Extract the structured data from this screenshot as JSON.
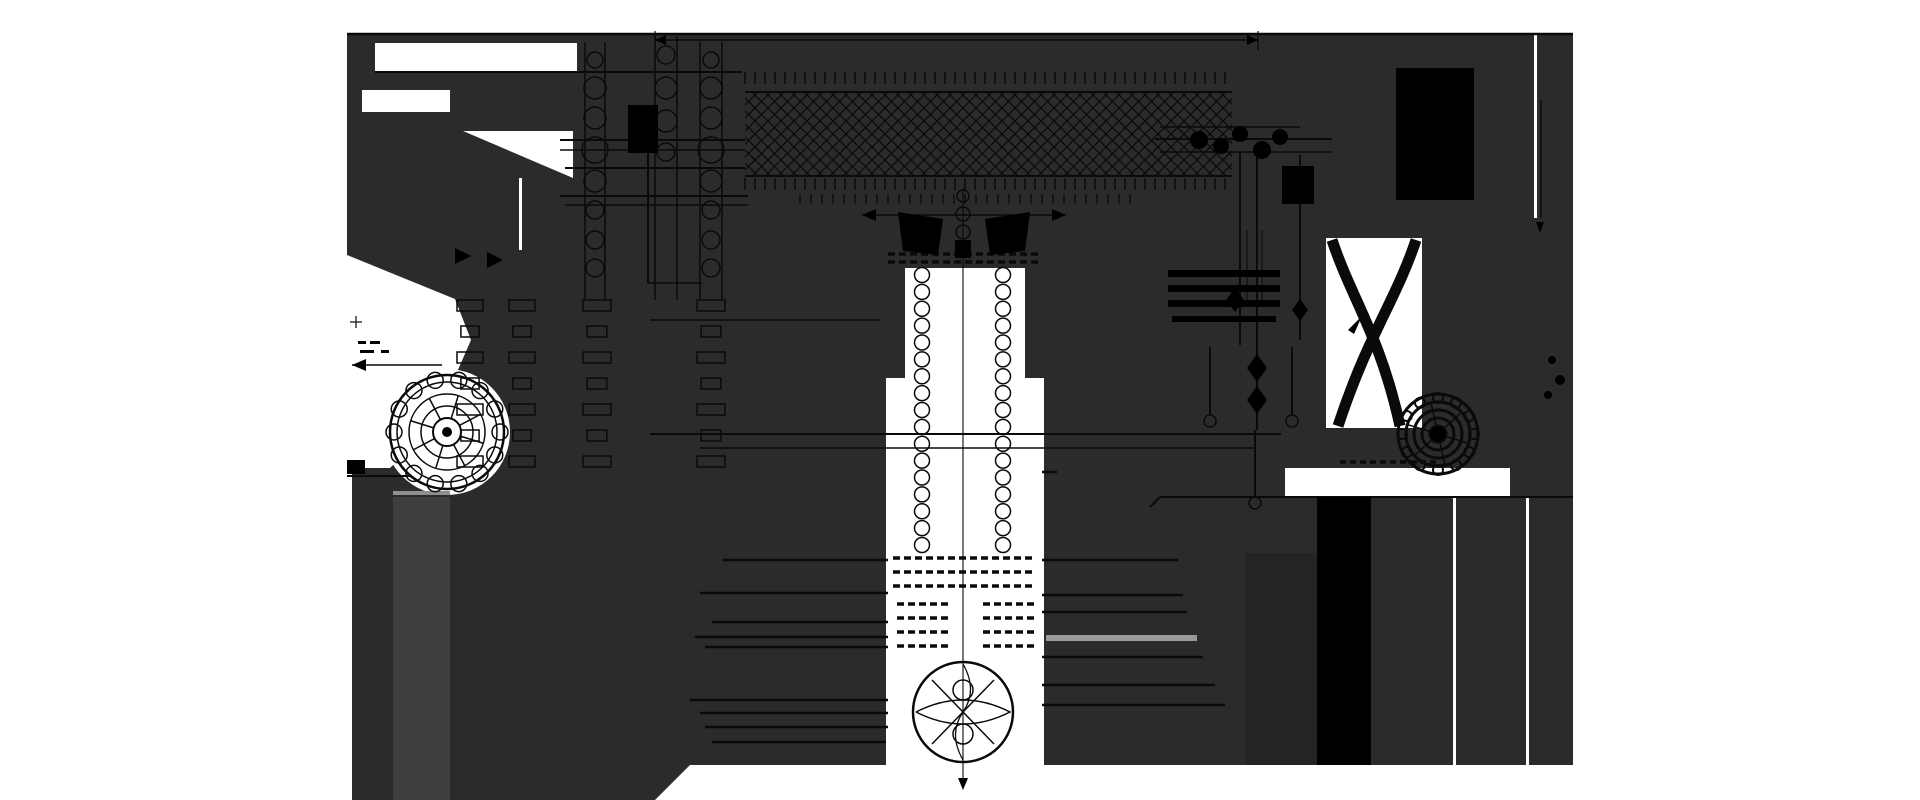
{
  "meta": {
    "title": "Monochrome engineering cross-section drawing, dark sheet silhouette with black line work",
    "width": 1920,
    "height": 800
  },
  "palette": {
    "bg": "#ffffff",
    "panel": "#2b2b2b",
    "slab": "#242424",
    "ink": "#0a0a0a",
    "solid": "#000000",
    "gray_bar": "#9a9a9a",
    "gray_band": "#3f3f3f",
    "gray_band_top": "#8f8f8f"
  },
  "silhouette": {
    "panel": [
      [
        347,
        33
      ],
      [
        1573,
        33
      ],
      [
        1573,
        765
      ],
      [
        690,
        765
      ],
      [
        655,
        800
      ],
      [
        352,
        800
      ],
      [
        352,
        470
      ],
      [
        347,
        462
      ]
    ],
    "cutout_rects": [
      [
        375,
        43,
        202,
        29
      ],
      [
        362,
        90,
        88,
        22
      ],
      [
        519,
        178,
        3,
        72
      ],
      [
        1285,
        468,
        225,
        29
      ],
      [
        1534,
        34,
        3,
        184
      ],
      [
        1453,
        497,
        3,
        268
      ],
      [
        1526,
        497,
        3,
        268
      ],
      [
        1326,
        238,
        96,
        190
      ],
      [
        905,
        268,
        120,
        112
      ],
      [
        886,
        378,
        158,
        422
      ]
    ],
    "cutout_polys": [
      [
        [
          463,
          131
        ],
        [
          573,
          131
        ],
        [
          573,
          178
        ]
      ],
      [
        [
          347,
          255
        ],
        [
          455,
          299
        ],
        [
          471,
          340
        ],
        [
          434,
          425
        ],
        [
          390,
          468
        ],
        [
          347,
          468
        ]
      ]
    ],
    "cutout_circles": [
      [
        447,
        432,
        63
      ]
    ]
  },
  "fills": {
    "gray_band": [
      393,
      497,
      57,
      303
    ],
    "gray_band_top": [
      393,
      491,
      57,
      4
    ],
    "pedestal_slab": [
      1245,
      553,
      72,
      212
    ]
  },
  "hatch": {
    "x": 745,
    "y": 92,
    "w": 487,
    "h": 84,
    "spacing": 13,
    "stroke_w": 1.2
  },
  "tick_rows": [
    {
      "y0": 72,
      "y1": 84,
      "x0": 745,
      "x1": 1232,
      "step": 10,
      "w": 1.5
    },
    {
      "y0": 178,
      "y1": 190,
      "x0": 745,
      "x1": 1232,
      "step": 10,
      "w": 1.5
    },
    {
      "y0": 194,
      "y1": 204,
      "x0": 800,
      "x1": 1140,
      "step": 11,
      "w": 1.2
    }
  ],
  "dash_rows": [
    {
      "y": 254,
      "x0": 888,
      "x1": 1038
    },
    {
      "y": 262,
      "x0": 888,
      "x1": 1038
    },
    {
      "y": 558,
      "x0": 893,
      "x1": 1035
    },
    {
      "y": 572,
      "x0": 893,
      "x1": 1035
    },
    {
      "y": 586,
      "x0": 893,
      "x1": 1035
    },
    {
      "y": 604,
      "x0": 897,
      "x1": 950
    },
    {
      "y": 604,
      "x0": 983,
      "x1": 1036
    },
    {
      "y": 618,
      "x0": 897,
      "x1": 950
    },
    {
      "y": 618,
      "x0": 983,
      "x1": 1036
    },
    {
      "y": 632,
      "x0": 897,
      "x1": 950
    },
    {
      "y": 632,
      "x0": 983,
      "x1": 1036
    },
    {
      "y": 646,
      "x0": 897,
      "x1": 950
    },
    {
      "y": 646,
      "x0": 983,
      "x1": 1036
    }
  ],
  "bead_chains": [
    {
      "cx": 922,
      "y0": 275,
      "y1": 545,
      "r": 7.5,
      "n": 17
    },
    {
      "cx": 1003,
      "y0": 275,
      "y1": 545,
      "r": 7.5,
      "n": 17
    }
  ],
  "nut_stacks": [
    {
      "cx": 470,
      "y0": 300,
      "y1": 470,
      "w": 26,
      "h": 11,
      "step": 26
    },
    {
      "cx": 522,
      "y0": 300,
      "y1": 470,
      "w": 26,
      "h": 11,
      "step": 26
    },
    {
      "cx": 597,
      "y0": 300,
      "y1": 470,
      "w": 28,
      "h": 11,
      "step": 26
    },
    {
      "cx": 711,
      "y0": 300,
      "y1": 470,
      "w": 28,
      "h": 11,
      "step": 26
    }
  ],
  "lines": [
    [
      347,
      34,
      1573,
      34,
      2.5
    ],
    [
      655,
      40,
      1258,
      40,
      1.5
    ],
    [
      655,
      31,
      655,
      50,
      1.2
    ],
    [
      1258,
      31,
      1258,
      50,
      1.2
    ],
    [
      648,
      113,
      648,
      283,
      2
    ],
    [
      648,
      283,
      702,
      283,
      1.5
    ],
    [
      375,
      72,
      742,
      72,
      2
    ],
    [
      560,
      140,
      745,
      140,
      2
    ],
    [
      560,
      150,
      745,
      150,
      1.5
    ],
    [
      565,
      168,
      745,
      168,
      2
    ],
    [
      560,
      196,
      748,
      196,
      2
    ],
    [
      565,
      205,
      748,
      205,
      1.5
    ],
    [
      585,
      42,
      585,
      300,
      1.5
    ],
    [
      605,
      42,
      605,
      300,
      1.5
    ],
    [
      655,
      36,
      655,
      300,
      1.5
    ],
    [
      677,
      36,
      677,
      300,
      1.5
    ],
    [
      700,
      42,
      700,
      300,
      1.5
    ],
    [
      722,
      42,
      722,
      300,
      1.5
    ],
    [
      745,
      92,
      1232,
      92,
      2
    ],
    [
      745,
      176,
      1232,
      176,
      2
    ],
    [
      862,
      215,
      1066,
      215,
      1.5
    ],
    [
      650,
      320,
      880,
      320,
      1.5
    ],
    [
      650,
      434,
      1281,
      434,
      2
    ],
    [
      700,
      448,
      1256,
      448,
      1.5
    ],
    [
      1160,
      127,
      1300,
      127,
      1.5
    ],
    [
      1155,
      139,
      1332,
      139,
      2
    ],
    [
      1160,
      152,
      1332,
      152,
      1.5
    ],
    [
      1240,
      152,
      1240,
      345,
      2
    ],
    [
      1257,
      150,
      1257,
      430,
      2
    ],
    [
      1300,
      155,
      1300,
      340,
      2
    ],
    [
      1247,
      230,
      1247,
      300,
      1
    ],
    [
      1262,
      230,
      1262,
      300,
      1
    ],
    [
      1160,
      497,
      1573,
      497,
      2
    ],
    [
      1150,
      507,
      1160,
      497,
      2
    ],
    [
      1541,
      100,
      1541,
      218,
      1.5
    ],
    [
      963,
      188,
      963,
      788,
      1.1
    ],
    [
      1210,
      347,
      1210,
      415,
      2
    ],
    [
      1292,
      347,
      1292,
      415,
      2
    ],
    [
      1255,
      430,
      1255,
      497,
      2
    ],
    [
      723,
      560,
      888,
      560,
      2.5
    ],
    [
      700,
      593,
      888,
      593,
      2.5
    ],
    [
      712,
      622,
      888,
      622,
      2.5
    ],
    [
      695,
      637,
      888,
      637,
      2.5
    ],
    [
      705,
      647,
      888,
      647,
      2.5
    ],
    [
      690,
      700,
      888,
      700,
      2.5
    ],
    [
      700,
      713,
      888,
      713,
      2.5
    ],
    [
      705,
      727,
      888,
      727,
      2.5
    ],
    [
      712,
      742,
      886,
      742,
      2.5
    ],
    [
      1042,
      472,
      1057,
      472,
      2.5
    ],
    [
      1042,
      560,
      1178,
      560,
      2.5
    ],
    [
      1042,
      595,
      1183,
      595,
      2.5
    ],
    [
      1042,
      612,
      1187,
      612,
      2.5
    ],
    [
      1042,
      657,
      1203,
      657,
      2.5
    ],
    [
      1042,
      685,
      1215,
      685,
      2.5
    ],
    [
      1042,
      705,
      1225,
      705,
      2.5
    ],
    [
      352,
      365,
      442,
      365,
      1.5
    ],
    [
      350,
      322,
      362,
      322,
      1.2
    ],
    [
      356,
      316,
      356,
      328,
      1.2
    ],
    [
      347,
      476,
      412,
      476,
      2
    ],
    [
      932,
      744,
      994,
      680,
      1.5
    ],
    [
      932,
      680,
      994,
      744,
      1.5
    ]
  ],
  "gray_lines": [
    [
      1046,
      638,
      1197,
      638,
      6
    ]
  ],
  "rects_black": [
    [
      628,
      105,
      30,
      48
    ],
    [
      1396,
      68,
      78,
      132
    ],
    [
      1317,
      497,
      54,
      268
    ],
    [
      1282,
      166,
      32,
      38
    ],
    [
      955,
      240,
      16,
      18
    ],
    [
      1168,
      270,
      112,
      7
    ],
    [
      1168,
      285,
      112,
      7
    ],
    [
      1168,
      300,
      112,
      7
    ],
    [
      1172,
      316,
      104,
      6
    ],
    [
      347,
      460,
      18,
      14
    ],
    [
      358,
      341,
      8,
      3
    ],
    [
      370,
      341,
      10,
      3
    ],
    [
      360,
      350,
      14,
      3
    ],
    [
      381,
      350,
      8,
      3
    ]
  ],
  "polys_black": [
    [
      [
        655,
        40
      ],
      [
        666,
        35
      ],
      [
        666,
        45
      ]
    ],
    [
      [
        1258,
        40
      ],
      [
        1247,
        35
      ],
      [
        1247,
        45
      ]
    ],
    [
      [
        862,
        215
      ],
      [
        876,
        209
      ],
      [
        876,
        221
      ]
    ],
    [
      [
        1066,
        215
      ],
      [
        1052,
        209
      ],
      [
        1052,
        221
      ]
    ],
    [
      [
        352,
        365
      ],
      [
        366,
        359
      ],
      [
        366,
        371
      ]
    ],
    [
      [
        898,
        212
      ],
      [
        943,
        219
      ],
      [
        938,
        255
      ],
      [
        903,
        251
      ]
    ],
    [
      [
        1030,
        212
      ],
      [
        985,
        219
      ],
      [
        990,
        255
      ],
      [
        1025,
        251
      ]
    ],
    [
      [
        455,
        248
      ],
      [
        471,
        256
      ],
      [
        455,
        264
      ]
    ],
    [
      [
        487,
        252
      ],
      [
        503,
        260
      ],
      [
        487,
        268
      ]
    ],
    [
      [
        1536,
        222
      ],
      [
        1544,
        222
      ],
      [
        1540,
        233
      ]
    ],
    [
      [
        963,
        790
      ],
      [
        958,
        778
      ],
      [
        968,
        778
      ]
    ],
    [
      [
        1235,
        288
      ],
      [
        1244,
        300
      ],
      [
        1235,
        312
      ],
      [
        1226,
        300
      ]
    ],
    [
      [
        1257,
        354
      ],
      [
        1267,
        368
      ],
      [
        1257,
        382
      ],
      [
        1247,
        368
      ]
    ],
    [
      [
        1257,
        386
      ],
      [
        1267,
        400
      ],
      [
        1257,
        414
      ],
      [
        1247,
        400
      ]
    ],
    [
      [
        1300,
        299
      ],
      [
        1308,
        310
      ],
      [
        1300,
        321
      ],
      [
        1292,
        310
      ]
    ],
    [
      [
        1348,
        330
      ],
      [
        1362,
        316
      ],
      [
        1354,
        334
      ]
    ]
  ],
  "circles_stroked": [
    [
      595,
      60,
      8
    ],
    [
      595,
      88,
      11
    ],
    [
      595,
      118,
      11
    ],
    [
      595,
      150,
      13
    ],
    [
      595,
      181,
      11
    ],
    [
      595,
      210,
      9
    ],
    [
      595,
      240,
      9
    ],
    [
      595,
      268,
      9
    ],
    [
      711,
      60,
      8
    ],
    [
      711,
      88,
      11
    ],
    [
      711,
      118,
      11
    ],
    [
      711,
      150,
      13
    ],
    [
      711,
      181,
      11
    ],
    [
      711,
      210,
      9
    ],
    [
      711,
      240,
      9
    ],
    [
      711,
      268,
      9
    ],
    [
      666,
      55,
      9
    ],
    [
      666,
      88,
      11
    ],
    [
      666,
      121,
      11
    ],
    [
      666,
      152,
      9
    ],
    [
      1210,
      421,
      6
    ],
    [
      1292,
      421,
      6
    ],
    [
      1255,
      503,
      6
    ],
    [
      963,
      196,
      6
    ],
    [
      963,
      214,
      7
    ],
    [
      963,
      232,
      7
    ],
    [
      963,
      690,
      10
    ],
    [
      963,
      734,
      10
    ],
    [
      963,
      712,
      50
    ]
  ],
  "circles_filled": [
    [
      1199,
      140,
      9
    ],
    [
      1221,
      146,
      8
    ],
    [
      1240,
      134,
      8
    ],
    [
      1262,
      150,
      9
    ],
    [
      1280,
      137,
      8
    ],
    [
      1552,
      360,
      4
    ],
    [
      1560,
      380,
      5
    ],
    [
      1548,
      395,
      4
    ]
  ],
  "paths": [
    {
      "d": "M1332,240 C1352,300 1380,335 1400,426",
      "w": 11
    },
    {
      "d": "M1416,240 C1396,300 1368,335 1338,426",
      "w": 11
    },
    {
      "d": "M916,712 Q963,688 1010,712 Q963,736 916,712",
      "w": 1.5
    },
    {
      "d": "M963,664 Q978,690 963,712 Q948,734 963,760",
      "w": 1.2
    }
  ],
  "rosettes": [
    {
      "cx": 447,
      "cy": 432,
      "rings": [
        57,
        50,
        38,
        26,
        14
      ],
      "ring_w": [
        2.5,
        1.5,
        1.5,
        1.5,
        2
      ],
      "bolt_r": 8,
      "bolt_count": 14,
      "bolt_at": 53,
      "spokes": 8,
      "spoke_r0": 14,
      "spoke_r1": 38,
      "center_r": 5,
      "stroke_w": 1.5
    },
    {
      "cx": 1438,
      "cy": 434,
      "rings": [
        40,
        32,
        24,
        16,
        8
      ],
      "ring_w": [
        3,
        3,
        3,
        3,
        3
      ],
      "bolt_r": 5,
      "bolt_count": 12,
      "bolt_at": 36,
      "spokes": 6,
      "spoke_r0": 8,
      "spoke_r1": 32,
      "center_r": 8,
      "stroke_w": 2
    }
  ],
  "rosette_dash_row": {
    "y": 462,
    "x0": 1340,
    "x1": 1440
  }
}
